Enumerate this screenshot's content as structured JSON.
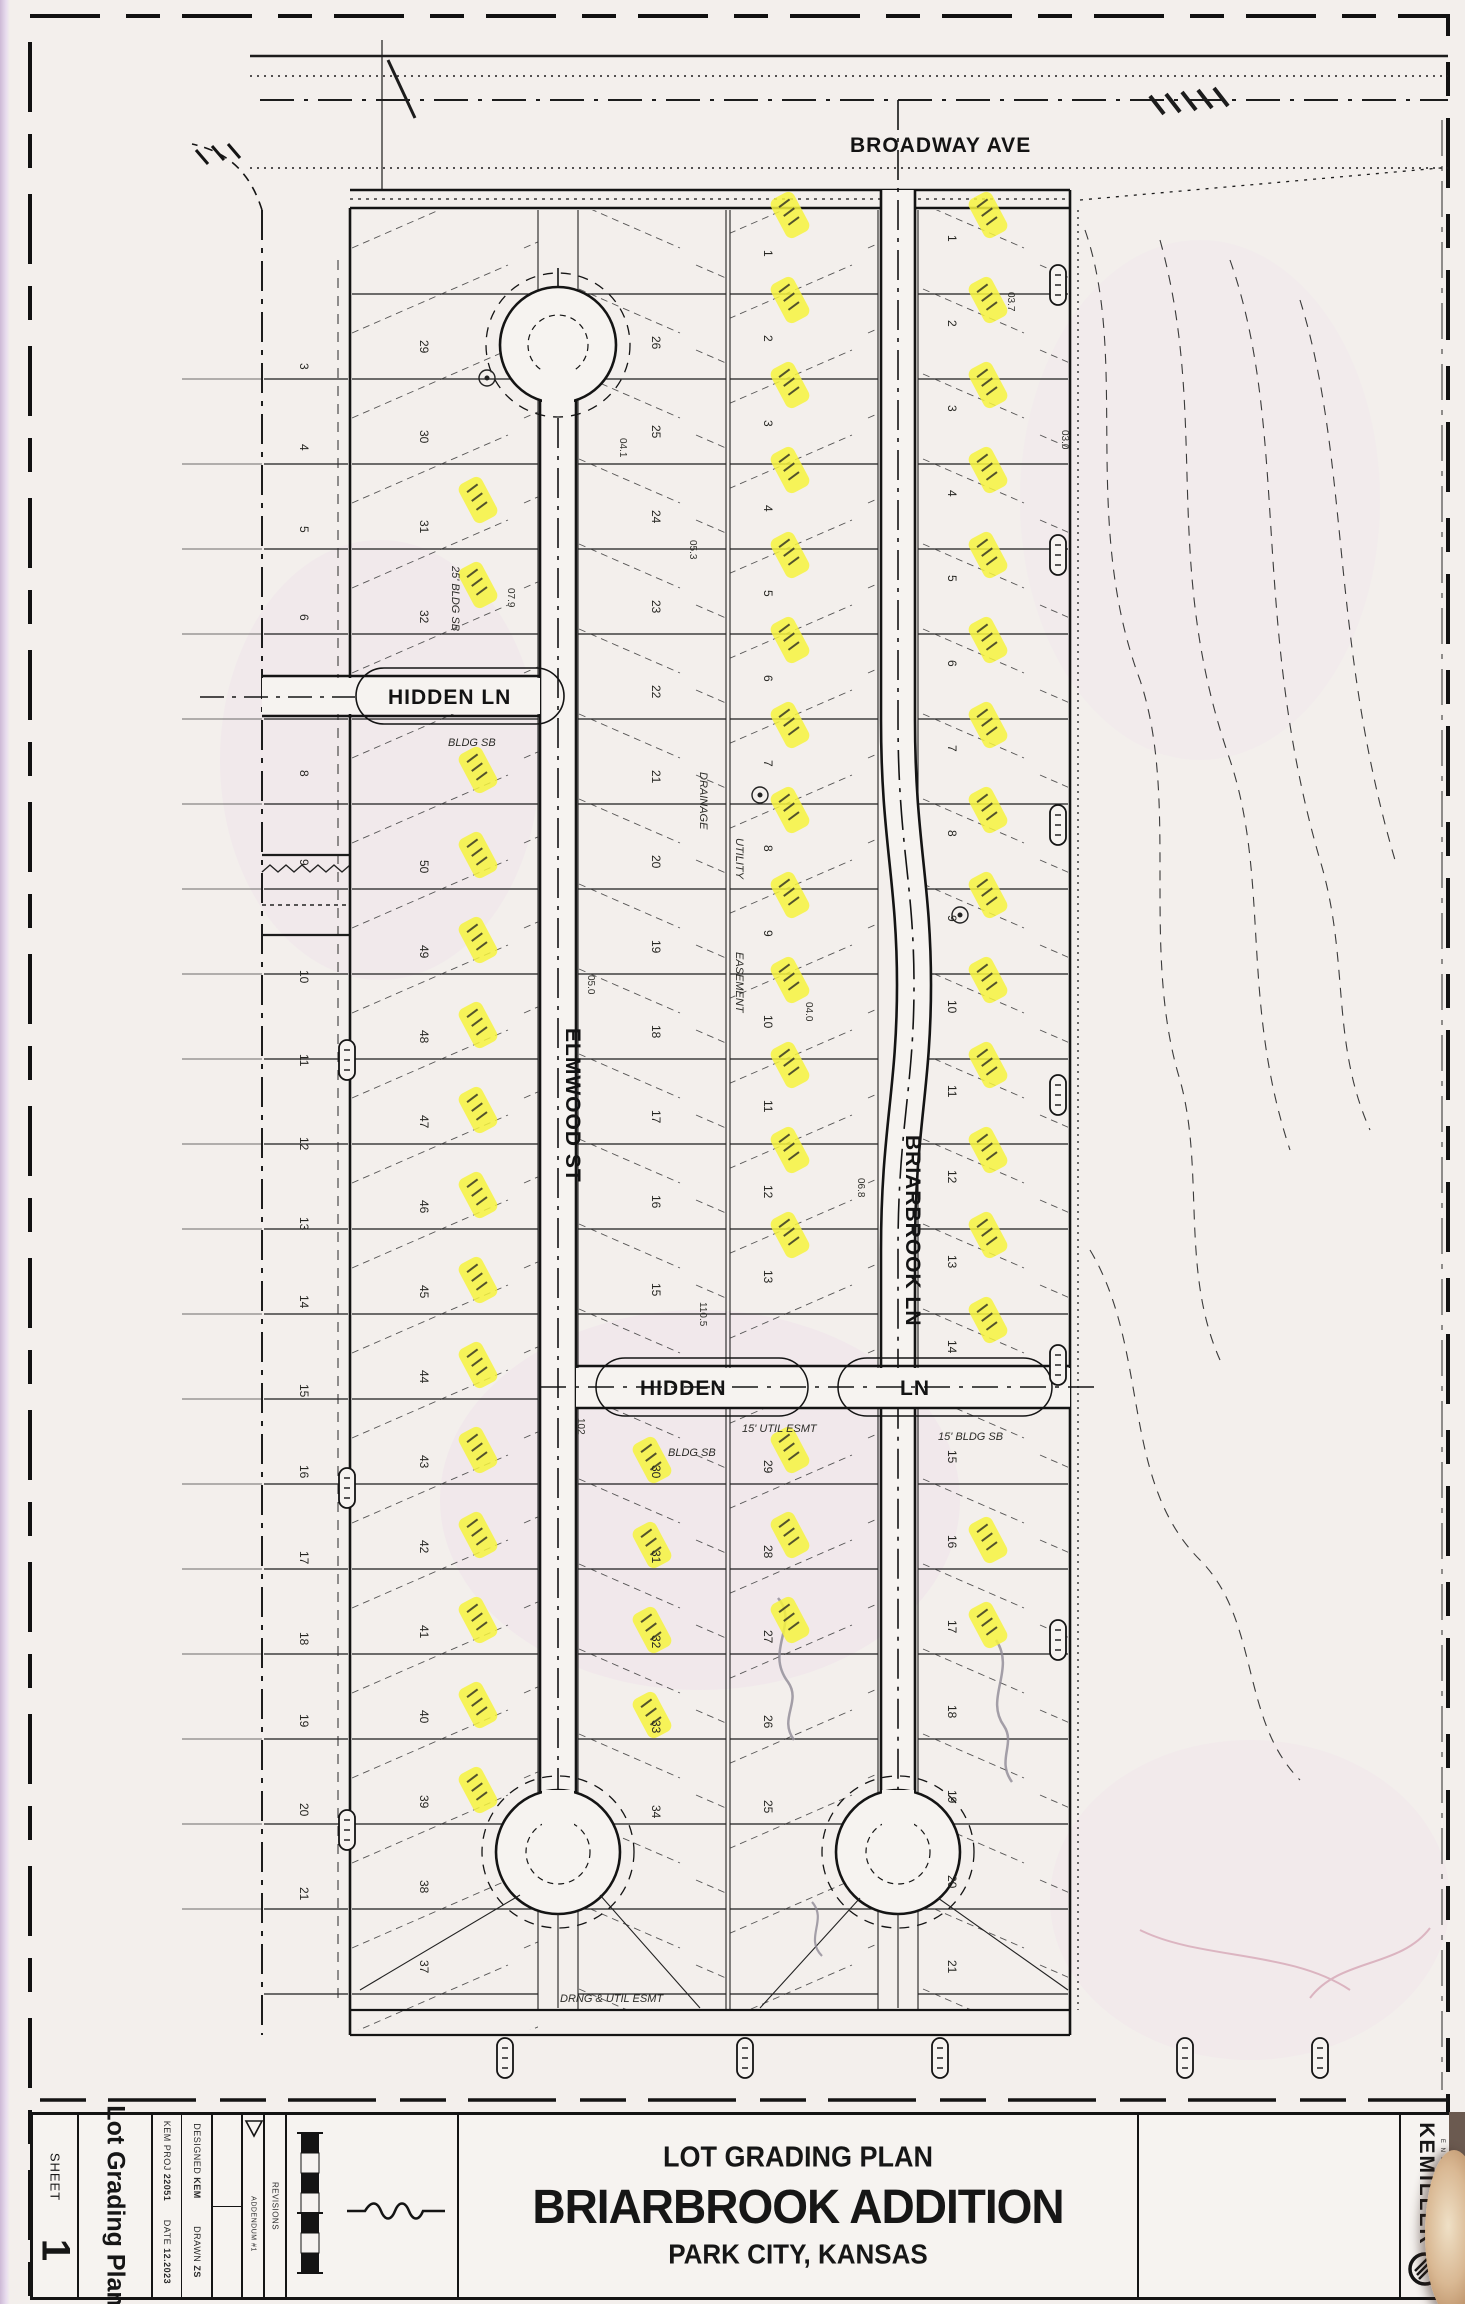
{
  "colors": {
    "highlight": "#f6f33e",
    "ink": "#161616",
    "paper": "#f3efec",
    "pink_tint": "#efdcEA"
  },
  "page": {
    "sheet_label": "SHEET",
    "sheet_number": "1",
    "side_title": "Lot Grading Plan"
  },
  "title_block": {
    "subtitle": "LOT GRADING PLAN",
    "title": "BRIARBROOK ADDITION",
    "location": "PARK CITY, KANSAS",
    "proj_label": "KEM PROJ",
    "proj_number": "22051",
    "designed_label": "DESIGNED",
    "designed_by": "KEM",
    "date_label": "DATE",
    "date_value": "12.2023",
    "drawn_label": "DRAWN",
    "drawn_by": "ZS",
    "revisions_label": "REVISIONS",
    "addendum": "ADDENDUM #1",
    "firm_name": "KEMILLER",
    "firm_sub": "E N G I N E E R I N G"
  },
  "plan": {
    "streets": {
      "broadway": "BROADWAY AVE",
      "hidden_west": "HIDDEN LN",
      "hidden_mid_1": "HIDDEN",
      "hidden_mid_2": "LN",
      "elmwood": "ELMWOOD ST",
      "briarbrook": "BRIARBROOK LN"
    },
    "annotations": {
      "bldg_sb": "BLDG SB",
      "bldg_sb2": "BLDG SB",
      "bldg_sb_25": "25' BLDG SB",
      "bldg_sb_15": "15' BLDG SB",
      "util_esmt": "15' UTIL ESMT",
      "drng_util": "DRNG & UTIL ESMT",
      "utility": "UTILITY",
      "easement": "EASEMENT",
      "drainage": "DRAINAGE"
    },
    "spots": [
      {
        "t": "05.3",
        "x": 690,
        "y": 540
      },
      {
        "t": "04.1",
        "x": 620,
        "y": 438
      },
      {
        "t": "07.9",
        "x": 508,
        "y": 588
      },
      {
        "t": "03.7",
        "x": 1008,
        "y": 292
      },
      {
        "t": "04.0",
        "x": 806,
        "y": 1002
      },
      {
        "t": "05.0",
        "x": 588,
        "y": 975
      },
      {
        "t": "102",
        "x": 578,
        "y": 1418
      },
      {
        "t": "110.5",
        "x": 700,
        "y": 1302
      },
      {
        "t": "06.8",
        "x": 858,
        "y": 1178
      },
      {
        "t": "03.0",
        "x": 1062,
        "y": 430
      }
    ],
    "margin_lots": [
      [
        "3",
        363
      ],
      [
        "4",
        444
      ],
      [
        "5",
        526
      ],
      [
        "6",
        614
      ],
      [
        "8",
        770
      ],
      [
        "9",
        859
      ],
      [
        "10",
        970
      ],
      [
        "11",
        1054
      ],
      [
        "12",
        1137
      ],
      [
        "13",
        1217
      ],
      [
        "14",
        1295
      ],
      [
        "15",
        1384
      ],
      [
        "16",
        1465
      ],
      [
        "17",
        1551
      ],
      [
        "18",
        1632
      ],
      [
        "19",
        1714
      ],
      [
        "20",
        1803
      ],
      [
        "21",
        1887
      ]
    ],
    "lot_numbers": [
      {
        "x": 420,
        "items": [
          [
            "29",
            340
          ],
          [
            "30",
            430
          ],
          [
            "31",
            520
          ],
          [
            "32",
            610
          ],
          [
            "50",
            860
          ],
          [
            "49",
            945
          ],
          [
            "48",
            1030
          ],
          [
            "47",
            1115
          ],
          [
            "46",
            1200
          ],
          [
            "45",
            1285
          ],
          [
            "44",
            1370
          ],
          [
            "43",
            1455
          ],
          [
            "42",
            1540
          ],
          [
            "41",
            1625
          ],
          [
            "40",
            1710
          ],
          [
            "39",
            1795
          ],
          [
            "38",
            1880
          ],
          [
            "37",
            1960
          ]
        ]
      },
      {
        "x": 652,
        "items": [
          [
            "26",
            336
          ],
          [
            "25",
            425
          ],
          [
            "24",
            510
          ],
          [
            "23",
            600
          ],
          [
            "22",
            685
          ],
          [
            "21",
            770
          ],
          [
            "20",
            855
          ],
          [
            "19",
            940
          ],
          [
            "18",
            1025
          ],
          [
            "17",
            1110
          ],
          [
            "16",
            1195
          ],
          [
            "15",
            1283
          ],
          [
            "30",
            1465
          ],
          [
            "31",
            1550
          ],
          [
            "32",
            1635
          ],
          [
            "33",
            1720
          ],
          [
            "34",
            1805
          ]
        ]
      },
      {
        "x": 764,
        "items": [
          [
            "1",
            250
          ],
          [
            "2",
            335
          ],
          [
            "3",
            420
          ],
          [
            "4",
            505
          ],
          [
            "5",
            590
          ],
          [
            "6",
            675
          ],
          [
            "7",
            760
          ],
          [
            "8",
            845
          ],
          [
            "9",
            930
          ],
          [
            "10",
            1015
          ],
          [
            "11",
            1100
          ],
          [
            "12",
            1185
          ],
          [
            "13",
            1270
          ],
          [
            "29",
            1460
          ],
          [
            "28",
            1545
          ],
          [
            "27",
            1630
          ],
          [
            "26",
            1715
          ],
          [
            "25",
            1800
          ]
        ]
      },
      {
        "x": 948,
        "items": [
          [
            "1",
            235
          ],
          [
            "2",
            320
          ],
          [
            "3",
            405
          ],
          [
            "4",
            490
          ],
          [
            "5",
            575
          ],
          [
            "6",
            660
          ],
          [
            "7",
            745
          ],
          [
            "8",
            830
          ],
          [
            "9",
            915
          ],
          [
            "10",
            1000
          ],
          [
            "11",
            1085
          ],
          [
            "12",
            1170
          ],
          [
            "13",
            1255
          ],
          [
            "14",
            1340
          ],
          [
            "15",
            1450
          ],
          [
            "16",
            1535
          ],
          [
            "17",
            1620
          ],
          [
            "18",
            1705
          ],
          [
            "19",
            1790
          ],
          [
            "20",
            1875
          ],
          [
            "21",
            1960
          ]
        ]
      }
    ],
    "highlights": [
      [
        478,
        500
      ],
      [
        478,
        585
      ],
      [
        478,
        770
      ],
      [
        478,
        855
      ],
      [
        478,
        940
      ],
      [
        478,
        1025
      ],
      [
        478,
        1110
      ],
      [
        478,
        1195
      ],
      [
        478,
        1280
      ],
      [
        478,
        1365
      ],
      [
        478,
        1450
      ],
      [
        478,
        1535
      ],
      [
        478,
        1620
      ],
      [
        478,
        1705
      ],
      [
        478,
        1790
      ],
      [
        652,
        1460
      ],
      [
        652,
        1545
      ],
      [
        652,
        1630
      ],
      [
        652,
        1715
      ],
      [
        790,
        215
      ],
      [
        790,
        300
      ],
      [
        790,
        385
      ],
      [
        790,
        470
      ],
      [
        790,
        555
      ],
      [
        790,
        640
      ],
      [
        790,
        725
      ],
      [
        790,
        810
      ],
      [
        790,
        895
      ],
      [
        790,
        980
      ],
      [
        790,
        1065
      ],
      [
        790,
        1150
      ],
      [
        790,
        1235
      ],
      [
        790,
        1450
      ],
      [
        790,
        1535
      ],
      [
        790,
        1620
      ],
      [
        988,
        215
      ],
      [
        988,
        300
      ],
      [
        988,
        385
      ],
      [
        988,
        470
      ],
      [
        988,
        555
      ],
      [
        988,
        640
      ],
      [
        988,
        725
      ],
      [
        988,
        810
      ],
      [
        988,
        895
      ],
      [
        988,
        980
      ],
      [
        988,
        1065
      ],
      [
        988,
        1150
      ],
      [
        988,
        1235
      ],
      [
        988,
        1320
      ],
      [
        988,
        1540
      ],
      [
        988,
        1625
      ]
    ],
    "ovals": [
      [
        1058,
        285
      ],
      [
        1058,
        555
      ],
      [
        1058,
        825
      ],
      [
        1058,
        1095
      ],
      [
        1058,
        1365
      ],
      [
        1058,
        1640
      ],
      [
        347,
        1060
      ],
      [
        347,
        1488
      ],
      [
        347,
        1830
      ],
      [
        505,
        2058
      ],
      [
        745,
        2058
      ],
      [
        940,
        2058
      ],
      [
        1185,
        2058
      ],
      [
        1320,
        2058
      ]
    ]
  }
}
